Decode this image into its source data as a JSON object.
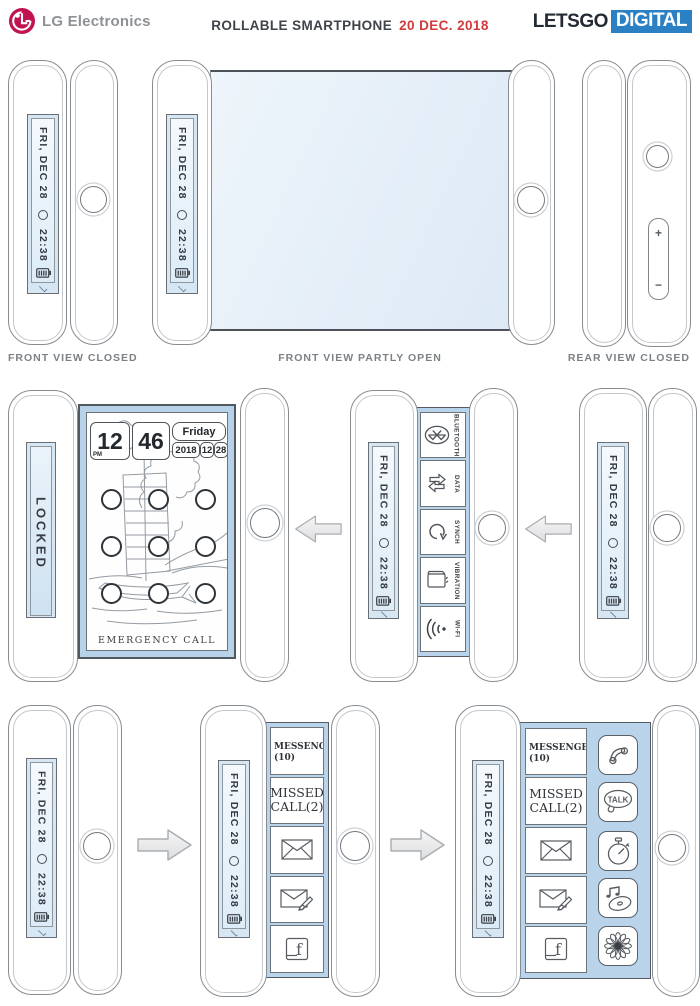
{
  "header": {
    "brand": "LG Electronics",
    "title": "ROLLABLE SMARTPHONE",
    "date": "20 DEC. 2018",
    "letsgo": "LETSGO",
    "digital": "DIGITAL"
  },
  "captions": {
    "row1_left": "FRONT VIEW CLOSED",
    "row1_center": "FRONT VIEW PARTLY OPEN",
    "row1_right": "REAR VIEW CLOSED"
  },
  "ticker": {
    "date": "FRI, DEC 28",
    "time": "22:38",
    "icons": [
      "status-circle-icon",
      "battery-icon",
      "chevron-down-icon"
    ]
  },
  "volume": {
    "plus": "+",
    "minus": "−"
  },
  "lock_screen": {
    "locked": "LOCKED",
    "hour": "12",
    "meridiem": "PM",
    "minute": "46",
    "weekday": "Friday",
    "year": "2018",
    "month": "12",
    "day": "28",
    "emergency": "EMERGENCY CALL",
    "pattern_dots": 9
  },
  "quick_settings": {
    "tiles": [
      {
        "label": "BLUETOOTH",
        "icon": "bluetooth-icon"
      },
      {
        "label": "DATA",
        "icon": "data-icon"
      },
      {
        "label": "SYNCH",
        "icon": "sync-icon"
      },
      {
        "label": "VIBRATION",
        "icon": "vibration-icon"
      },
      {
        "label": "WI-FI",
        "icon": "wifi-icon"
      }
    ]
  },
  "notifications": {
    "messenger_line1": "MESSENGER",
    "messenger_line2": "(10)",
    "missed_line1": "MISSED",
    "missed_line2": "CALL(2)",
    "icons": [
      "mail-icon",
      "compose-mail-icon",
      "facebook-icon"
    ]
  },
  "apps": {
    "talk_label": "TALK",
    "icons": [
      "phone-icon",
      "talk-icon",
      "stopwatch-icon",
      "music-icon",
      "flower-icon"
    ]
  },
  "colors": {
    "lg_pink": "#c11352",
    "digital_blue": "#2b80c4",
    "date_red": "#d23a3d",
    "screen_blue": "#e8f1f9",
    "panel_blue": "#b9d3ea"
  }
}
